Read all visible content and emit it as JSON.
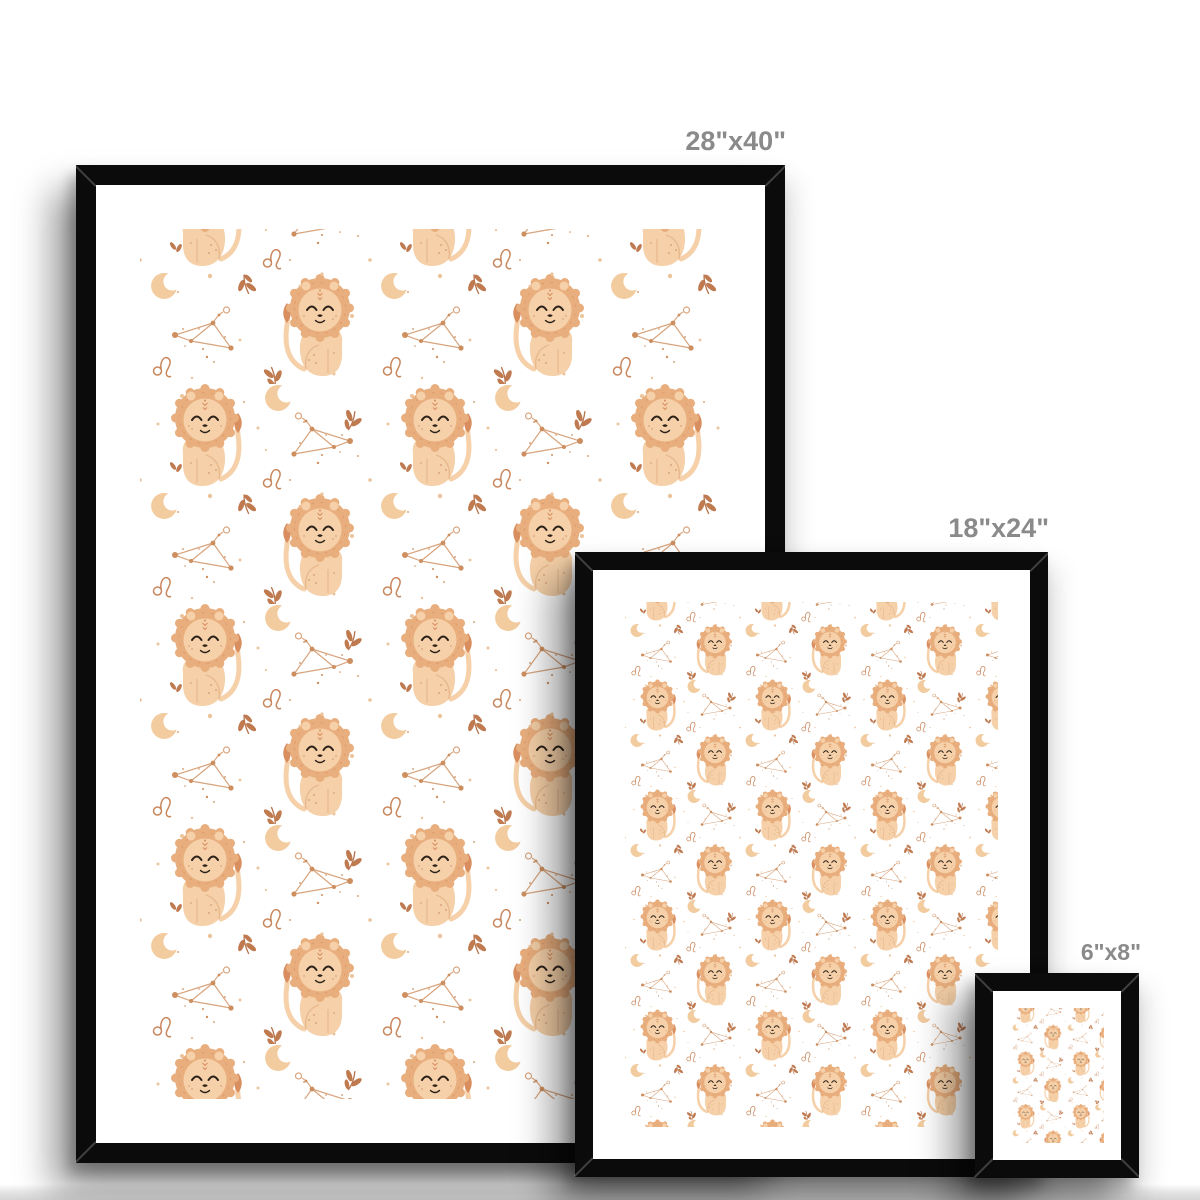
{
  "page": {
    "description": "Framed art print size comparison mockup",
    "background_color": "#ffffff",
    "floor_shadow_color": "#d9d9d9",
    "label_color": "#8a8a8a"
  },
  "frames": [
    {
      "id": "frame-28x40",
      "size_label": "28\"x40\"",
      "frame_color": "#0b0b0b",
      "matte_color": "#ffffff"
    },
    {
      "id": "frame-18x24",
      "size_label": "18\"x24\"",
      "frame_color": "#0b0b0b",
      "matte_color": "#ffffff"
    },
    {
      "id": "frame-6x8",
      "size_label": "6\"x8\"",
      "frame_color": "#0b0b0b",
      "matte_color": "#ffffff"
    }
  ],
  "artwork": {
    "title": "Leo baby lion zodiac nursery pattern",
    "motifs": [
      "lion",
      "leo-constellation",
      "crescent-moon",
      "leo-zodiac-symbol",
      "leaf-sprig",
      "sparkle-dots"
    ],
    "colors": {
      "mane": "#e9ae7d",
      "body": "#f5d0a8",
      "accent": "#d98e60",
      "ink": "#2b2119",
      "line": "#e8b98e",
      "freckle": "#dba678",
      "moon": "#f2cb9f",
      "leaf": "#bf7a50",
      "leaf_stem": "#b5714a",
      "leo_symbol": "#c9875d",
      "constellation_line": "#d49a6f",
      "constellation_dot": "#cd8f60",
      "dot": "#ecc49c",
      "background": "#ffffff"
    }
  }
}
